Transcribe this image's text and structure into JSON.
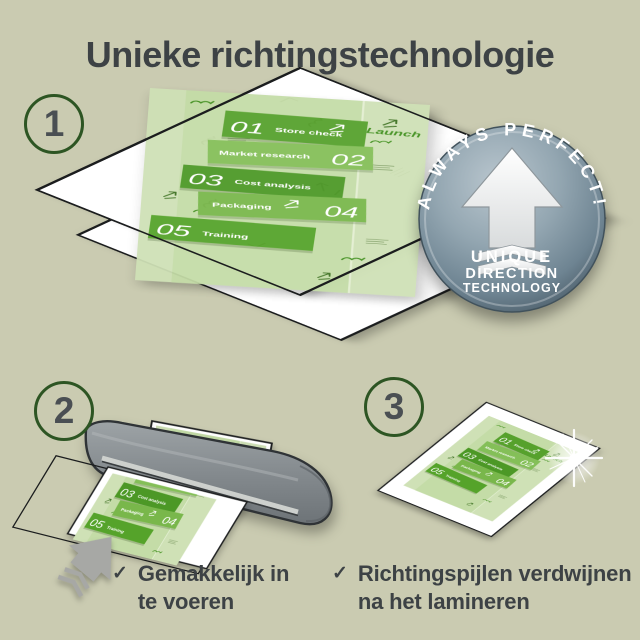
{
  "page": {
    "title": "Unieke richtingstechnologie",
    "background_color": "#cacbb1",
    "text_color": "#3d4245"
  },
  "steps": [
    {
      "number": "1"
    },
    {
      "number": "2"
    },
    {
      "number": "3"
    }
  ],
  "badge": {
    "arc_text": "ALWAYS PERFECT!",
    "lines": [
      "UNIQUE",
      "DIRECTION",
      "TECHNOLOGY"
    ],
    "base_color": "#879aa6"
  },
  "infographic": {
    "launch_label": "Launch",
    "items": [
      {
        "num": "01",
        "label": "Store check"
      },
      {
        "num": "02",
        "label": "Market research"
      },
      {
        "num": "03",
        "label": "Cost analysis"
      },
      {
        "num": "04",
        "label": "Packaging"
      },
      {
        "num": "05",
        "label": "Training"
      }
    ]
  },
  "checklist": {
    "check_icon": "✓",
    "items": [
      {
        "lines": [
          "Gemakkelijk in",
          "te voeren"
        ]
      },
      {
        "lines": [
          "Richtingspijlen verdwijnen",
          "na het lamineren"
        ]
      }
    ]
  },
  "colors": {
    "accent_green_dark": "#4c9826",
    "accent_green_mid": "#56a12c",
    "accent_green_light": "#84bf58",
    "sheet_green_pale": "#cfe1b6",
    "circle_border_green": "#2d5523",
    "machine_gray": "#878d91",
    "arrow_gray": "#a7a8a5"
  }
}
